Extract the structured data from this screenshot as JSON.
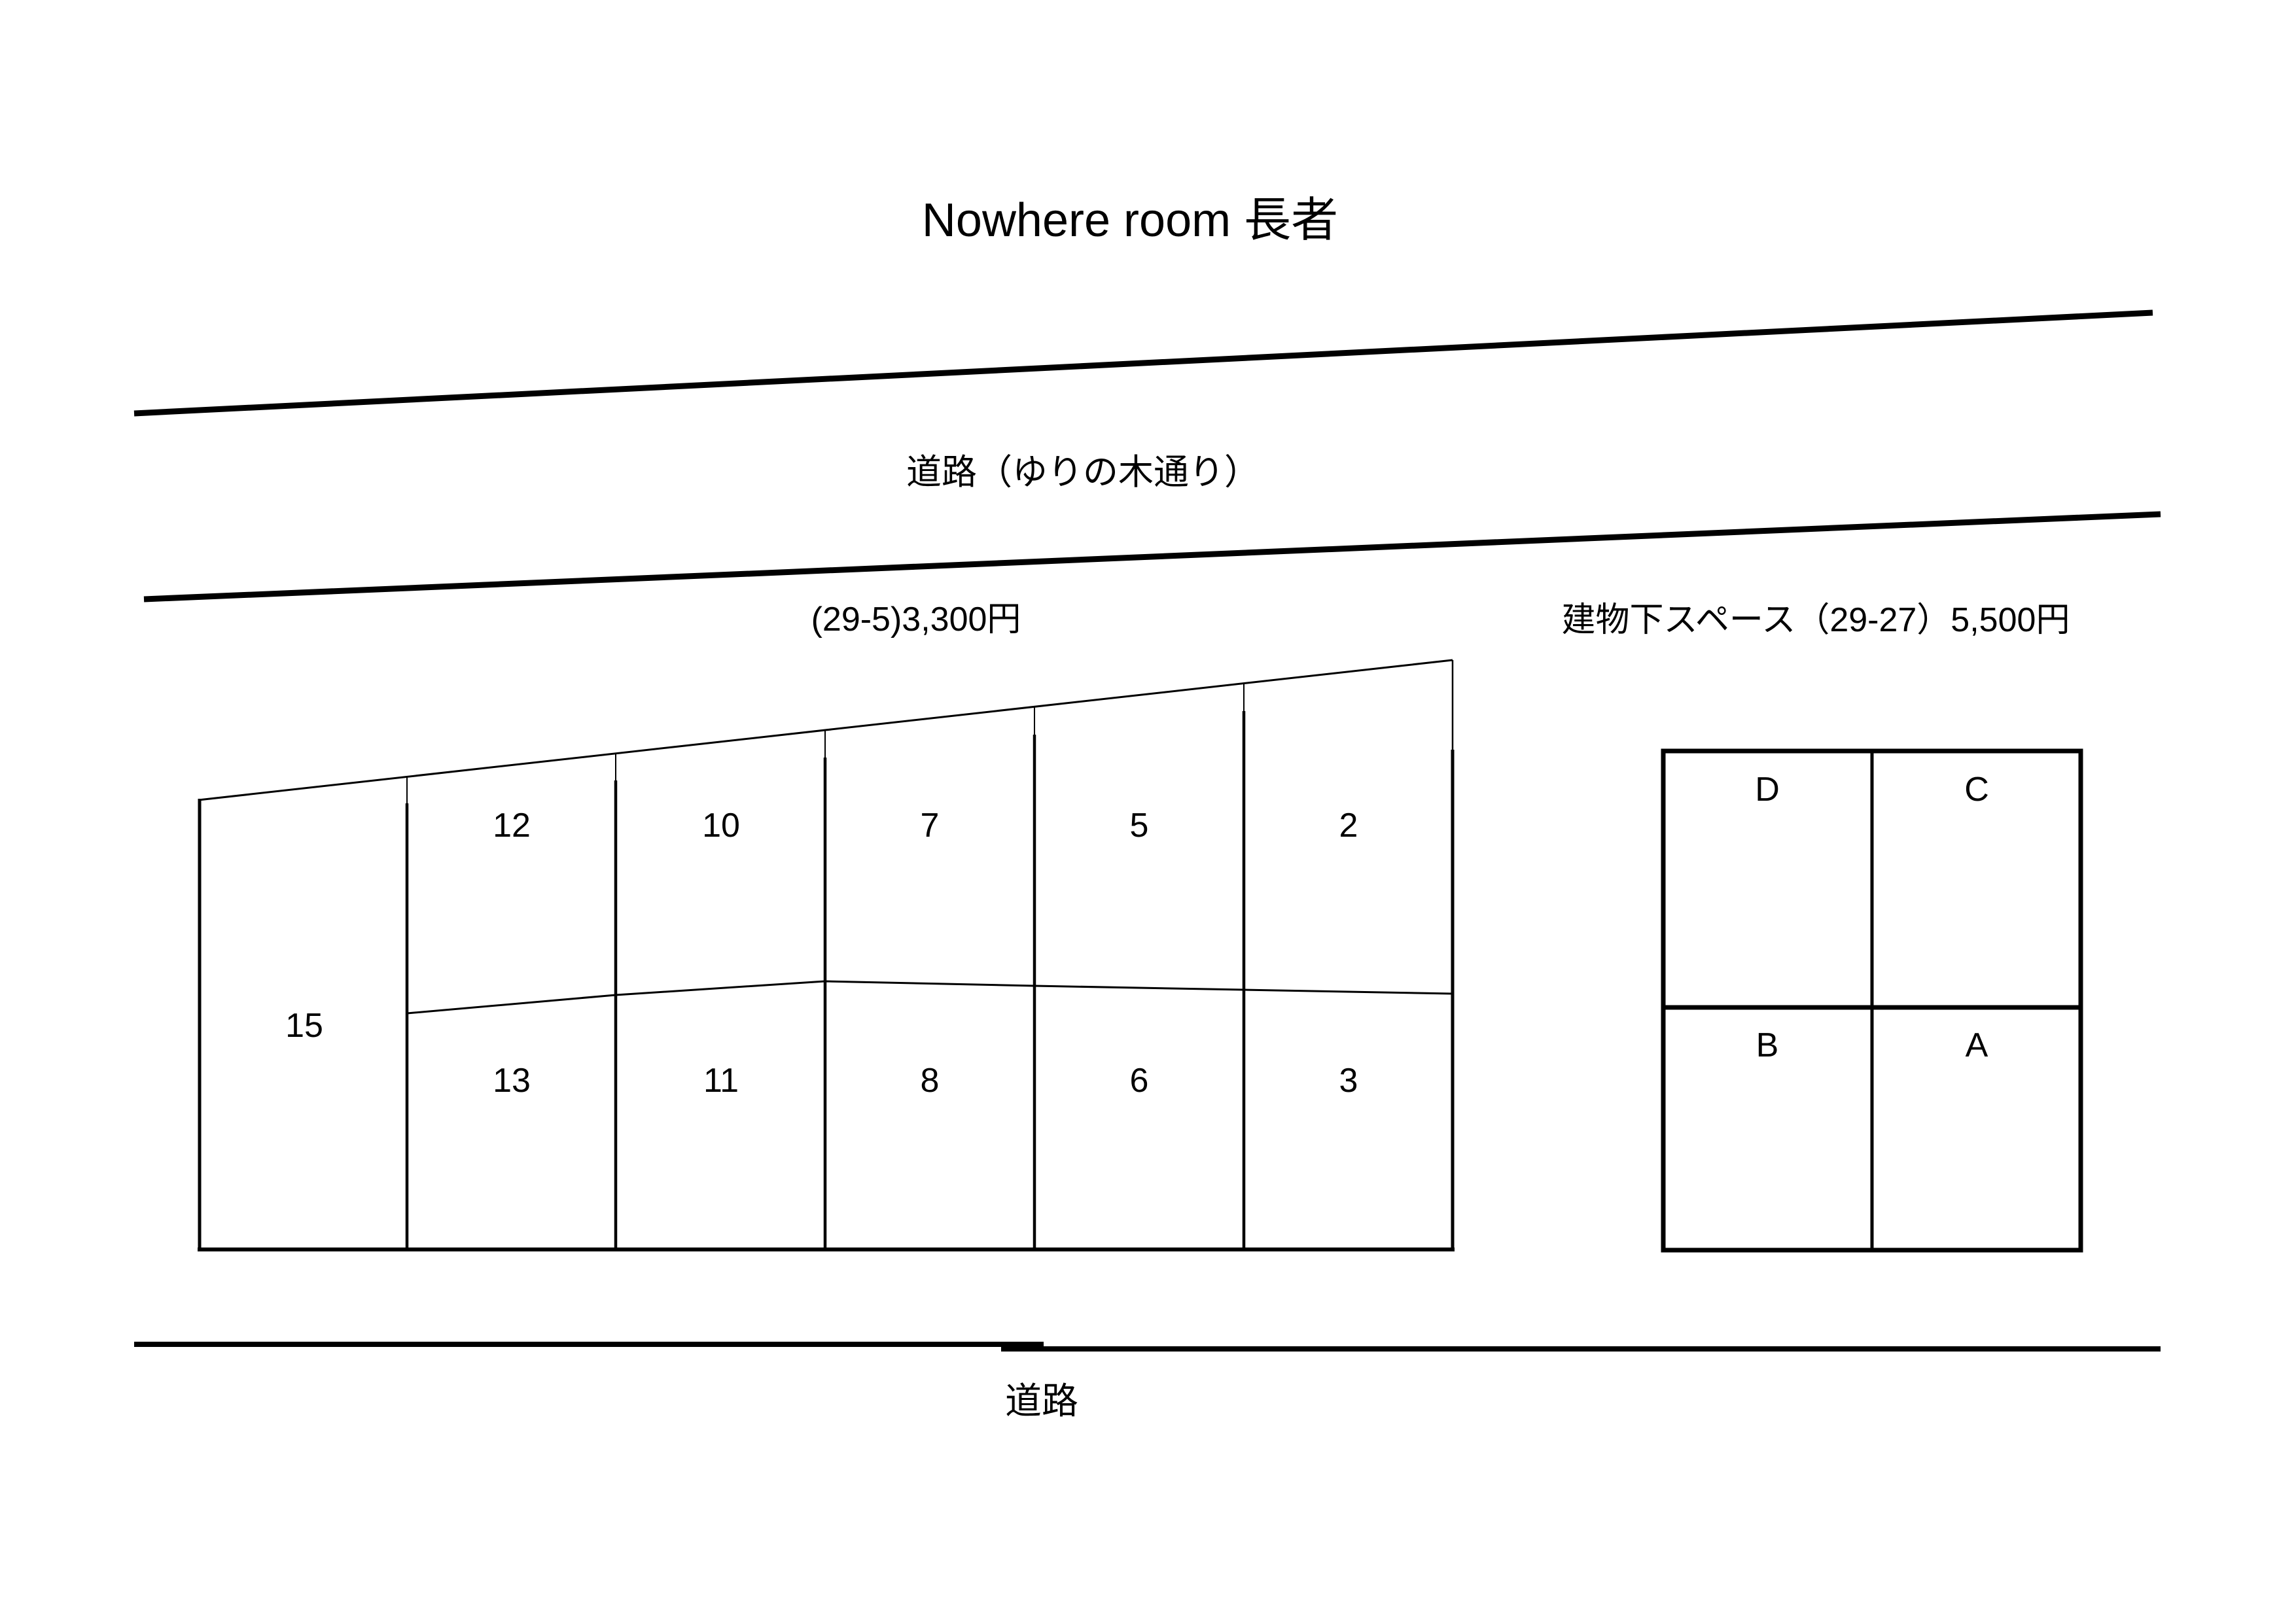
{
  "title": "Nowhere room 長者",
  "top_road": {
    "label": "道路（ゆりの木通り）"
  },
  "bottom_road": {
    "label": "道路"
  },
  "open_lot": {
    "price_label": "(29-5)3,300円",
    "full_height_space": "15",
    "top_row": [
      "12",
      "10",
      "7",
      "5",
      "2"
    ],
    "bottom_row": [
      "13",
      "11",
      "8",
      "6",
      "3"
    ]
  },
  "covered_lot": {
    "title_label": "建物下スペース（29-27）5,500円",
    "top_row": [
      "D",
      "C"
    ],
    "bottom_row": [
      "B",
      "A"
    ]
  },
  "colors": {
    "line": "#000000",
    "background": "#ffffff",
    "text": "#000000"
  }
}
